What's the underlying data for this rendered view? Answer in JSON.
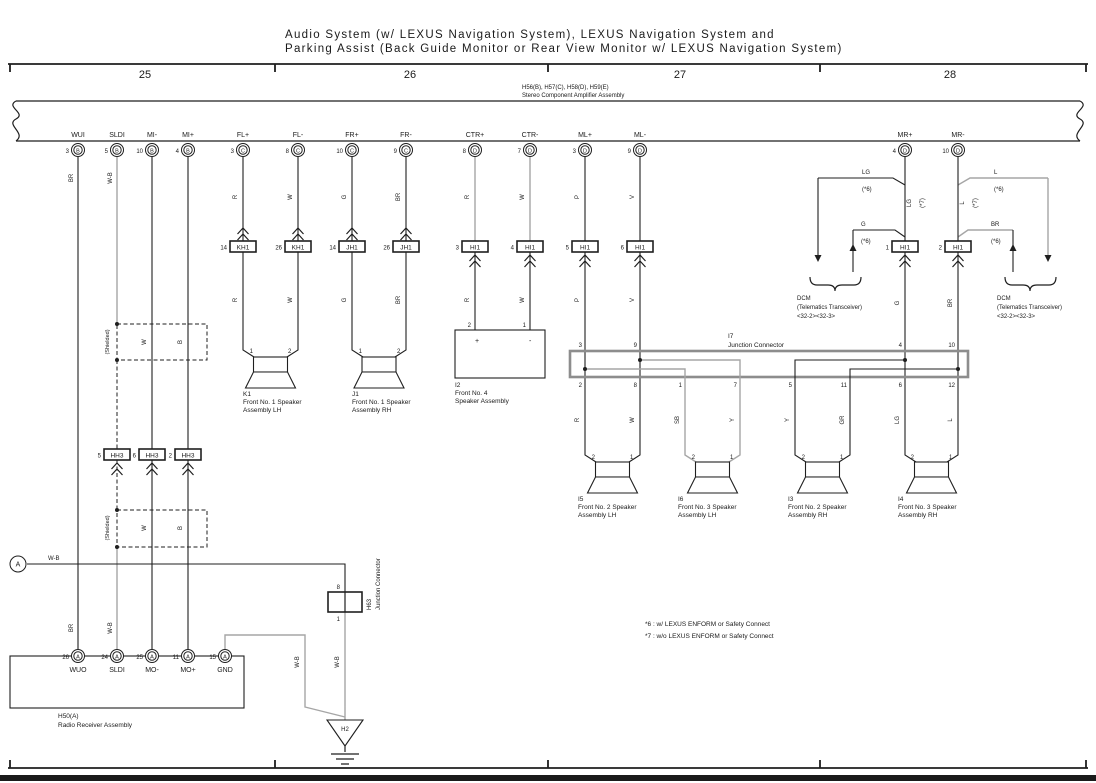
{
  "header": {
    "title_line1": "Audio System (w/ LEXUS Navigation System),  LEXUS Navigation System and",
    "title_line2": "Parking Assist (Back Guide Monitor or Rear View Monitor w/ LEXUS Navigation System)",
    "columns": [
      "25",
      "26",
      "27",
      "28"
    ]
  },
  "amplifier": {
    "codes": "H56(B), H57(C), H58(D), H59(E)",
    "name": "Stereo Component Amplifier Assembly",
    "pins": [
      {
        "num": "3",
        "letter": "B",
        "name": "WUI"
      },
      {
        "num": "5",
        "letter": "B",
        "name": "SLDI"
      },
      {
        "num": "10",
        "letter": "B",
        "name": "MI-"
      },
      {
        "num": "4",
        "letter": "B",
        "name": "MI+"
      },
      {
        "num": "3",
        "letter": "C",
        "name": "FL+"
      },
      {
        "num": "8",
        "letter": "C",
        "name": "FL-"
      },
      {
        "num": "10",
        "letter": "C",
        "name": "FR+"
      },
      {
        "num": "9",
        "letter": "C",
        "name": "FR-"
      },
      {
        "num": "8",
        "letter": "D",
        "name": "CTR+"
      },
      {
        "num": "7",
        "letter": "D",
        "name": "CTR-"
      },
      {
        "num": "3",
        "letter": "D",
        "name": "ML+"
      },
      {
        "num": "9",
        "letter": "D",
        "name": "ML-"
      },
      {
        "num": "4",
        "letter": "D",
        "name": "MR+"
      },
      {
        "num": "10",
        "letter": "D",
        "name": "MR-"
      }
    ]
  },
  "connectors": {
    "kh1_a": {
      "num": "14",
      "label": "KH1"
    },
    "kh1_b": {
      "num": "26",
      "label": "KH1"
    },
    "jh1_a": {
      "num": "14",
      "label": "JH1"
    },
    "jh1_b": {
      "num": "26",
      "label": "JH1"
    },
    "hi1_3": {
      "num": "3",
      "label": "HI1"
    },
    "hi1_4": {
      "num": "4",
      "label": "HI1"
    },
    "hi1_5": {
      "num": "5",
      "label": "HI1"
    },
    "hi1_6": {
      "num": "6",
      "label": "HI1"
    },
    "hi1_1": {
      "num": "1",
      "label": "HI1"
    },
    "hi1_2": {
      "num": "2",
      "label": "HI1"
    },
    "hh3_5": {
      "num": "5",
      "label": "HH3"
    },
    "hh3_6": {
      "num": "6",
      "label": "HH3"
    },
    "hh3_2": {
      "num": "2",
      "label": "HH3"
    }
  },
  "wires": {
    "br": "BR",
    "wb": "W-B",
    "r": "R",
    "w": "W",
    "g": "G",
    "p": "P",
    "v": "V",
    "lg": "LG",
    "l": "L",
    "sb": "SB",
    "y": "Y",
    "gr": "GR",
    "b": "B",
    "star6": "(*6)",
    "star7": "(*7)",
    "shielded": "(Shielded)"
  },
  "junction_i7": {
    "ref": "I7",
    "name": "Junction Connector",
    "top_pins": [
      "3",
      "9",
      "4",
      "10"
    ],
    "bottom_pins": [
      "2",
      "8",
      "1",
      "7",
      "5",
      "11",
      "6",
      "12"
    ]
  },
  "speakers": {
    "k1": {
      "ref": "K1",
      "line1": "Front No. 1 Speaker",
      "line2": "Assembly LH",
      "pin_left": "1",
      "pin_right": "2"
    },
    "j1": {
      "ref": "J1",
      "line1": "Front No. 1 Speaker",
      "line2": "Assembly RH",
      "pin_left": "1",
      "pin_right": "2"
    },
    "i2": {
      "ref": "I2",
      "line1": "Front No. 4",
      "line2": "Speaker Assembly",
      "pin_left": "2",
      "pin_right": "1",
      "plus": "+",
      "minus": "-"
    },
    "i5": {
      "ref": "I5",
      "line1": "Front No. 2 Speaker",
      "line2": "Assembly LH",
      "pin_left": "2",
      "pin_right": "1"
    },
    "i6": {
      "ref": "I6",
      "line1": "Front No. 3 Speaker",
      "line2": "Assembly LH",
      "pin_left": "2",
      "pin_right": "1"
    },
    "i3": {
      "ref": "I3",
      "line1": "Front No. 2 Speaker",
      "line2": "Assembly RH",
      "pin_left": "2",
      "pin_right": "1"
    },
    "i4": {
      "ref": "I4",
      "line1": "Front No. 3 Speaker",
      "line2": "Assembly RH",
      "pin_left": "2",
      "pin_right": "1"
    }
  },
  "dcm": {
    "line1": "DCM",
    "line2": "(Telematics Transceiver)",
    "line3": "<32-2><32-3>"
  },
  "radio": {
    "ref": "H50(A)",
    "name": "Radio Receiver Assembly",
    "pins": [
      {
        "num": "26",
        "letter": "A",
        "name": "WUO"
      },
      {
        "num": "24",
        "letter": "A",
        "name": "SLDI"
      },
      {
        "num": "25",
        "letter": "A",
        "name": "MO-"
      },
      {
        "num": "11",
        "letter": "A",
        "name": "MO+"
      },
      {
        "num": "15",
        "letter": "A",
        "name": "GND"
      }
    ]
  },
  "h63": {
    "ref": "H63",
    "name": "Junction Connector",
    "pin_top": "8",
    "pin_bottom": "1"
  },
  "ground": {
    "ref": "H2"
  },
  "circuit_a": {
    "label": "A"
  },
  "notes": [
    "*6 : w/ LEXUS ENFORM or Safety Connect",
    "*7 : w/o LEXUS ENFORM or Safety Connect"
  ]
}
